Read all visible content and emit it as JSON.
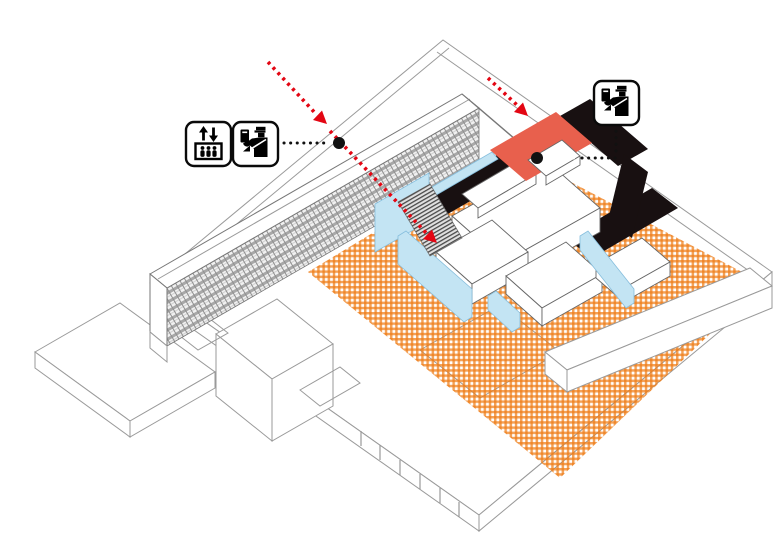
{
  "page": {
    "type": "axonometric architectural circulation diagram",
    "background": "#ffffff"
  },
  "colors": {
    "accent_red": "#e30613",
    "coral": "#e8604d",
    "orange": "#ef7d17",
    "blue_wall": "#c3e4f3",
    "blue_edge": "#86bedd",
    "black_floor": "#181011",
    "line_gray": "#9a9a9a",
    "line_dark": "#777777"
  },
  "legend": {
    "left_group": {
      "icons": [
        "elevator",
        "passport-control"
      ]
    },
    "right_group": {
      "icons": [
        "passport-control"
      ]
    }
  },
  "annotations": {
    "entry_arrows": [
      {
        "id": "arrow-upper-left",
        "style": "red-dashed",
        "direction": "down-right"
      },
      {
        "id": "arrow-upper-right",
        "style": "red-dashed",
        "direction": "down-right"
      }
    ],
    "reference_points": [
      {
        "id": "dot-roof-left"
      },
      {
        "id": "dot-red-roof"
      }
    ]
  },
  "elements": {
    "courtyard_pattern": "orange-checker",
    "circulation_floor": "black",
    "glass_walls": "light-blue",
    "highlighted_roof": "coral-red",
    "stair": "hatched-with-red-arrow",
    "buildings": [
      "long-slab-building",
      "podium-wireframe",
      "terminal-plan"
    ]
  }
}
